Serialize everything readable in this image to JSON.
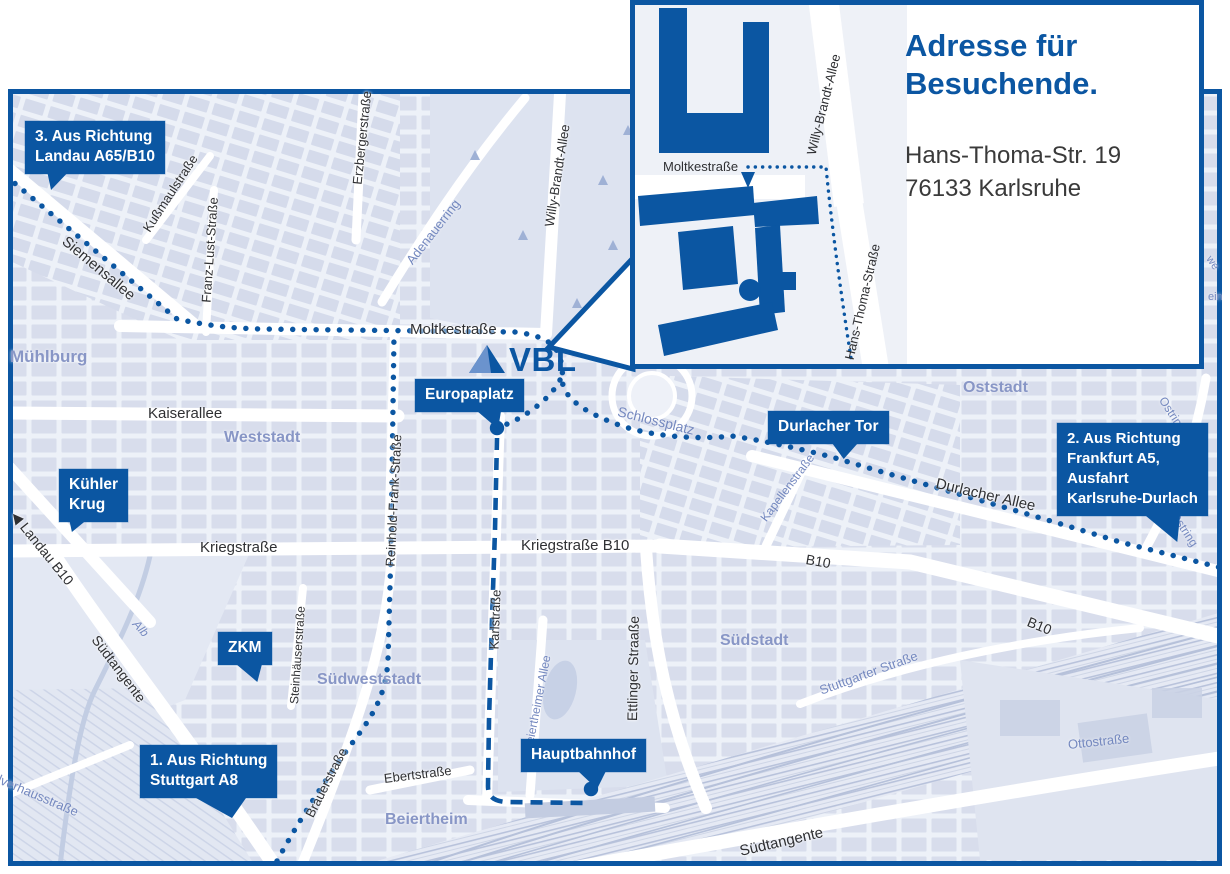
{
  "colors": {
    "brand_blue": "#0b56a2",
    "logo_light": "#6b93cd",
    "map_bg": "#edf1f8",
    "block": "#d8ddec",
    "park": "#dde3f0",
    "area_label": "#8896c6",
    "street_blue": "#7488bf",
    "street_dark": "#2f3033",
    "rail": "#b6c1da",
    "address_text": "#3a3a3a"
  },
  "logo": {
    "text": "VBL"
  },
  "inset": {
    "title_line1": "Adresse für",
    "title_line2": "Besuchende.",
    "address_line1": "Hans-Thoma-Str. 19",
    "address_line2": "76133 Karlsruhe",
    "labels": {
      "moltkestrasse": "Moltkestraße",
      "willy_brandt_allee": "Willy-Brandt-Allee",
      "hans_thoma_strasse": "Hans-Thoma-Straße"
    }
  },
  "map": {
    "callouts": {
      "landau": {
        "line1": "3. Aus Richtung",
        "line2": "Landau A65/B10"
      },
      "europaplatz": {
        "line1": "Europaplatz"
      },
      "durlacher_tor": {
        "line1": "Durlacher Tor"
      },
      "frankfurt": {
        "line1": "2. Aus Richtung",
        "line2": "Frankfurt A5,",
        "line3": "Ausfahrt",
        "line4": "Karlsruhe-Durlach"
      },
      "kuehler_krug": {
        "line1": "Kühler",
        "line2": "Krug"
      },
      "zkm": {
        "line1": "ZKM"
      },
      "stuttgart": {
        "line1": "1. Aus Richtung",
        "line2": "Stuttgart A8"
      },
      "hauptbahnhof": {
        "line1": "Hauptbahnhof"
      }
    },
    "labels": {
      "siemensallee": "Siemensallee",
      "kussmaulstrasse": "Kußmaulstraße",
      "franz_lust": "Franz-Lust-Straße",
      "erzbergerstrasse": "Erzbergerstraße",
      "muehlburg": "Mühlburg",
      "adenauerring": "Adenauerring",
      "willy_brandt": "Willy-Brandt-Allee",
      "moltkestrasse": "Moltkestraße",
      "kaiserallee": "Kaiserallee",
      "weststadt": "Weststadt",
      "reinhold_frank": "Reinhold-Frank-Straße",
      "kriegstrasse": "Kriegstraße",
      "kriegstrasse_b10": "Kriegstraße B10",
      "karlstrasse": "Karlstraße",
      "ettlinger_strasse": "Ettlinger Straaße",
      "schlossplatz": "Schlossplatz",
      "durlacher_allee": "Durlacher Allee",
      "kapellenstrasse": "Kapellenstraße",
      "b10_mid": "B10",
      "b10_right": "B10",
      "ostring_1": "Ostring",
      "ostring_2": "Ostring",
      "oststadt": "Oststadt",
      "suedstadt": "Südstadt",
      "stuttgarter_strasse": "Stuttgarter Straße",
      "suedtangente_sw": "Südtangente",
      "suedtangente_se": "Südtangente",
      "alb": "Alb",
      "ottostrasse": "Ottostraße",
      "steinhaeuser": "Steinhäuserstraße",
      "suedweststadt": "Südweststadt",
      "brauerstrasse": "Brauerstraße",
      "ebertstrasse": "Ebertstraße",
      "beiertheim": "Beiertheim",
      "landau_b10": "◀ Landau B10",
      "pulverhausstrasse": "Pulverhausstraße",
      "beiertheimer_allee": "Beiertheimer Allee",
      "fragment_we": "we",
      "fragment_ein": "ein"
    }
  }
}
